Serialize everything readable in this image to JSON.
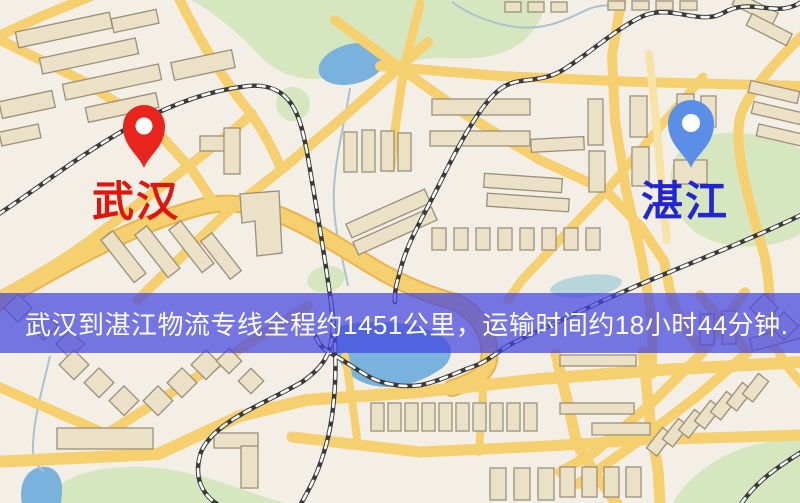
{
  "banner": {
    "text": "武汉到湛江物流专线全程约1451公里，运输时间约18小时44分钟.",
    "origin": "武汉",
    "destination": "湛江",
    "service": "物流专线",
    "distance_km": "1451",
    "duration_hours": "18",
    "duration_minutes": "44",
    "bg_color": "#4244e2",
    "text_color": "#ffffff"
  },
  "markers": {
    "origin": {
      "label": "武汉",
      "pin_icon": "red-map-pin",
      "pin_color": "#e8251c",
      "label_color": "#e0160c"
    },
    "destination": {
      "label": "湛江",
      "pin_icon": "blue-map-pin",
      "pin_color": "#5b8ee6",
      "label_color": "#2025d6"
    }
  },
  "map_colors": {
    "background": "#f3efe6",
    "road": "#f6cf6f",
    "road_casing": "#e9b44c",
    "minor_road": "#f8e3a6",
    "building_fill": "#ebe1c6",
    "building_stroke": "#9b8f79",
    "green_area": "#d6e7bf",
    "water": "#79b2dc",
    "railway": "#3a3a3a"
  }
}
